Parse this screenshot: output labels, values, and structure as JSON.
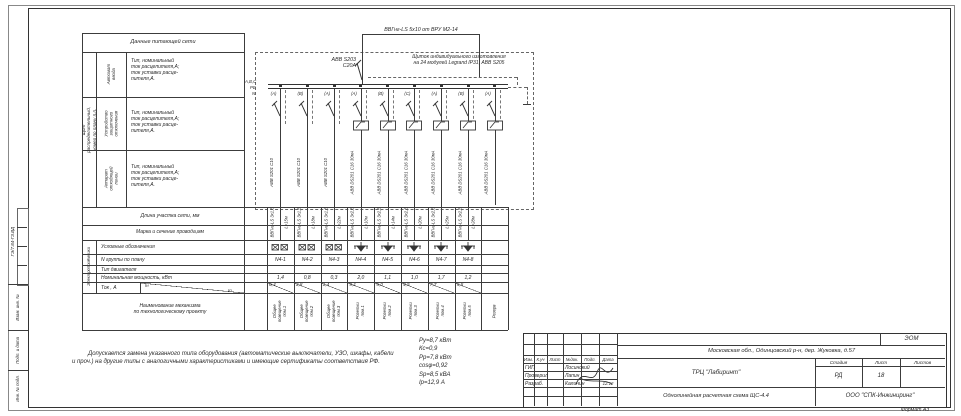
{
  "frame": {
    "format_label": "Формат А3",
    "doc_code": "ГЭ/7.84-ГЗ.ВД",
    "side_cells": [
      "Взам. инв. №",
      "Подп. и дата",
      "Инв. № подл."
    ]
  },
  "feeder_table": {
    "title": "Данные питающей сети",
    "group_label": "Щит распределительный,\nномер по плану п.п.",
    "rows": [
      {
        "label": "Автомат\nввода",
        "desc": "Тип, номинальный\nток расцепителя,А;\nток уставки расце-\nпителя,А."
      },
      {
        "label": "Устройство\nзащитного\nотключения",
        "desc": "Тип, номинальный\nток расцепителя,А;\nток уставки расце-\nпителя,А."
      },
      {
        "label": "Аппарат\nотходящей\nлинии",
        "desc": "Тип, номинальный\nток расцепителя,А;\nток уставки расце-\nпителя,А."
      }
    ],
    "length_row": "Длина участка сети, мм",
    "cable_row": "Марка и сечение провода,мм"
  },
  "consumers_table": {
    "group_label": "Электроприёмники",
    "symbol_row": "Условные обозначения",
    "group_row": "N группы по плану",
    "motor_row": "Тип двигателя",
    "power_row": "Номинальная мощность, кВт",
    "current_row": "Ток , А",
    "current_upper": "Iн",
    "current_lower": "Iп",
    "name_row": "Наименование механизма\nпо технологическому проекту"
  },
  "schematic": {
    "incoming_cable": "ВВГнг-LS 5х10 от ВРУ М2-14",
    "main_breaker": "АВВ S203\nС20А",
    "panel_note": "Щиток индивидуального изготовления\nна 24 модулей Legrand IP31, АВВ S205",
    "bus_phases": "А,В,С",
    "bus_pe": "PE",
    "bus_n": "N",
    "lines": [
      {
        "phase": "(А)",
        "device": "АВВ S201 C10",
        "cable": "ВВГнг-LS 3х1,5",
        "length": "L=15м",
        "symbol": "lum",
        "rcd": false,
        "group": "N4-1",
        "power": "1,4",
        "current": "6,4",
        "name": "Общее освещение\nпом.1"
      },
      {
        "phase": "(В)",
        "device": "АВВ S201 C10",
        "cable": "ВВГнг-LS 3х1,5",
        "length": "L=18м",
        "symbol": "lum",
        "rcd": false,
        "group": "N4-2",
        "power": "0,8",
        "current": "3,8",
        "name": "Общее освещение\nпом.2"
      },
      {
        "phase": "(А)",
        "device": "АВВ S201 C10",
        "cable": "ВВГнг-LS 3х1,5",
        "length": "L=22м",
        "symbol": "lum",
        "rcd": false,
        "group": "N4-3",
        "power": "0,3",
        "current": "1,4",
        "name": "Общее освещение\nпом.3"
      },
      {
        "phase": "(А)",
        "device": "АВВ DS201 C16 30мА",
        "cable": "ВВГнг-LS 3х2,5",
        "length": "L=10м",
        "symbol": "socket",
        "rcd": true,
        "group": "N4-4",
        "power": "2,0",
        "current": "9,1",
        "name": "Розетки\nпом.1"
      },
      {
        "phase": "(В)",
        "device": "АВВ DS201 C16 30мА",
        "cable": "ВВГнг-LS 3х2,5",
        "length": "L=14м",
        "symbol": "socket",
        "rcd": true,
        "group": "N4-5",
        "power": "1,1",
        "current": "5,0",
        "name": "Розетки\nпом.2"
      },
      {
        "phase": "(С)",
        "device": "АВВ DS201 C16 30мА",
        "cable": "ВВГнг-LS 3х2,5",
        "length": "L=20м",
        "symbol": "socket",
        "rcd": true,
        "group": "N4-6",
        "power": "1,0",
        "current": "4,5",
        "name": "Розетки\nпом.3"
      },
      {
        "phase": "(А)",
        "device": "АВВ DS201 C16 30мА",
        "cable": "ВВГнг-LS 3х2,5",
        "length": "L=25м",
        "symbol": "socket",
        "rcd": true,
        "group": "N4-7",
        "power": "1,7",
        "current": "7,7",
        "name": "Розетки\nпом.4"
      },
      {
        "phase": "(В)",
        "device": "АВВ DS201 C16 30мА",
        "cable": "ВВГнг-LS 3х2,5",
        "length": "L=28м",
        "symbol": "socket",
        "rcd": true,
        "group": "N4-8",
        "power": "1,2",
        "current": "5,5",
        "name": "Розетки\nпом.5"
      },
      {
        "phase": "(А)",
        "device": "АВВ DS201 C16 30мА",
        "cable": "",
        "length": "",
        "symbol": "none",
        "rcd": true,
        "group": "",
        "power": "",
        "current": "",
        "name": "Резерв"
      }
    ]
  },
  "notes": {
    "disclaimer": "Допускается замена указанного типа оборудования (автоматические выключатели, УЗО, шкафы, кабели и проч.) на другие типы с аналогичными характеристиками и имеющие сертификаты соответствия РФ."
  },
  "project_summary": [
    "Ру=8,7 кВт",
    "Кс=0,9",
    "Рр=7,8 кВт",
    "cosφ=0,92",
    "Sр=8,5 кВА",
    "Iр=12,9 А"
  ],
  "title_block": {
    "code_top": "ЭОМ",
    "address": "Московская обл., Одинцовский р-н, дер. Жуковка, д.57",
    "header_cols": [
      "Изм.",
      "К.уч",
      "Лист",
      "№док.",
      "Подп.",
      "Дата"
    ],
    "staff": [
      {
        "role": "ГИП",
        "name": "Лосинский",
        "date": ""
      },
      {
        "role": "Проверил",
        "name": "Лапин",
        "date": ""
      },
      {
        "role": "Разраб.",
        "name": "Калинин",
        "date": "12.12"
      }
    ],
    "project": "ТРЦ \"Лабиринт\"",
    "drawing_title": "Однолинейная расчетная схема ЩС-4.4",
    "stage_label": "Стадия",
    "sheet_label": "Лист",
    "sheets_label": "Листов",
    "stage": "РД",
    "sheet": "18",
    "sheets": "",
    "company": "ООО \"СПК-Инжиниринг\""
  }
}
